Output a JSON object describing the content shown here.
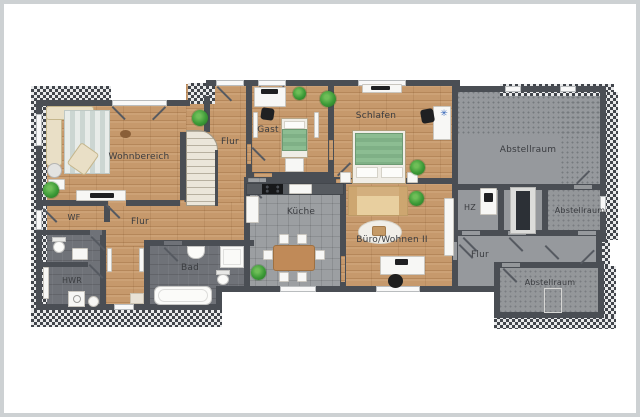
{
  "floorplan": {
    "type": "residential floor plan",
    "rooms": {
      "wohnbereich": {
        "label": "Wohnbereich"
      },
      "flur_mitte": {
        "label": "Flur"
      },
      "gast": {
        "label": "Gast"
      },
      "schlafen": {
        "label": "Schlafen"
      },
      "abstellraum_oben": {
        "label": "Abstellraum"
      },
      "wf": {
        "label": "WF"
      },
      "flur_links": {
        "label": "Flur"
      },
      "hwr": {
        "label": "HWR"
      },
      "bad": {
        "label": "Bad"
      },
      "kueche": {
        "label": "Küche"
      },
      "buero_wohnen": {
        "label": "Büro/Wohnen II"
      },
      "hz": {
        "label": "HZ"
      },
      "abstellraum_mitte": {
        "label": "Abstellraum"
      },
      "flur_rechts": {
        "label": "Flur"
      },
      "abstellraum_unten": {
        "label": "Abstellraum"
      }
    },
    "colors": {
      "wall": "#4a4e54",
      "wood_floor": "#c6996c",
      "kitchen_tile": "#9c9fa2",
      "wet_room_floor": "#6f7278",
      "storage_floor": "#94979a",
      "label_text": "#3a3c40",
      "plant_green": "#3c9a37",
      "bedding_green": "#8cbd92",
      "frame_border": "#cdd1d3"
    }
  }
}
